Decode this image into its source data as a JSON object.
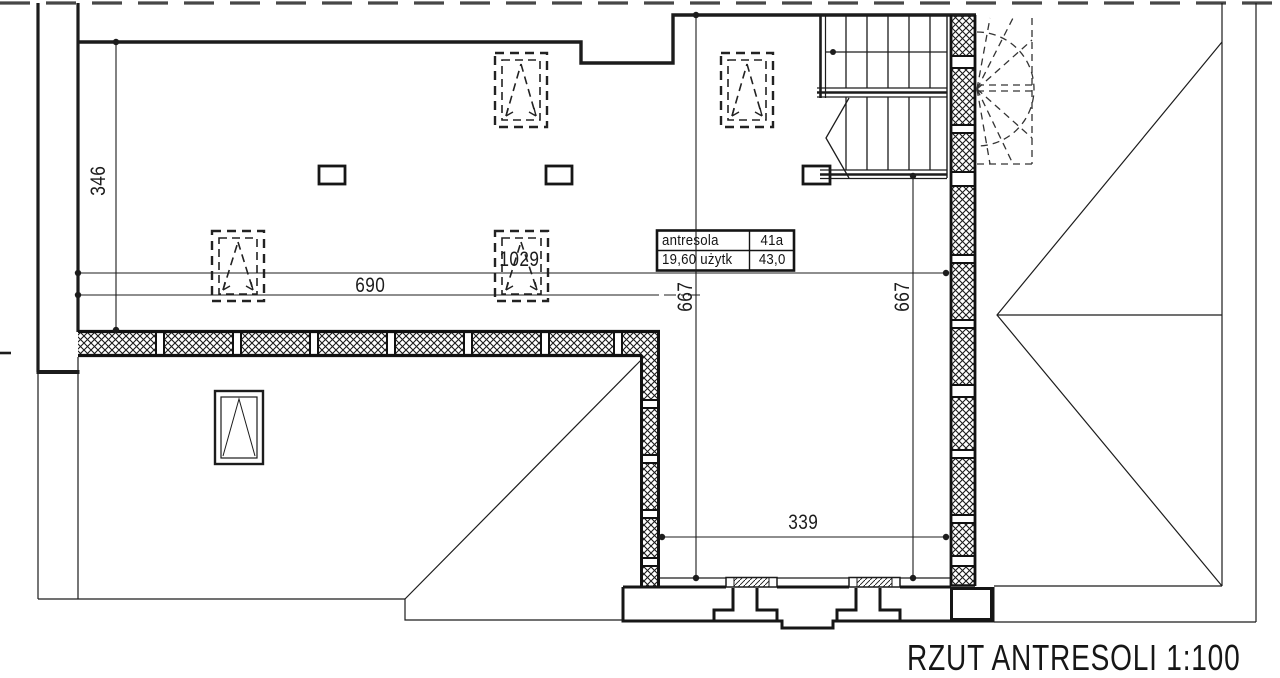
{
  "title": {
    "text": "RZUT ANTRESOLI 1:100"
  },
  "dims": {
    "h346": "346",
    "w1029": "1029",
    "w690": "690",
    "d667_left": "667",
    "d667_right": "667",
    "w339": "339"
  },
  "area_table": {
    "r1c1": "antresola",
    "r1c2": "41a",
    "r2c1": "19,60 użytk",
    "r2c2": "43,0"
  },
  "colors": {
    "ink": "#1c1c1c",
    "roof_dash": "#474747",
    "paper": "#ffffff"
  },
  "symbols": [
    "roof-window-icon",
    "chimney-icon",
    "window-icon",
    "stair-flight-icon",
    "winder-stair-dashed-icon",
    "insulated-wall-hatch"
  ]
}
